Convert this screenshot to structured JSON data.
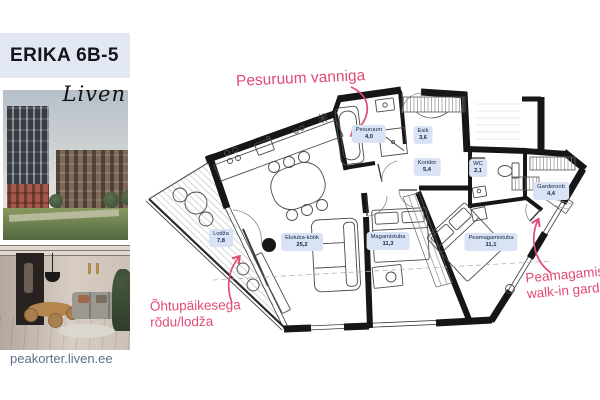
{
  "sidebar": {
    "title": "ERIKA 6B-5",
    "brand": "Liven",
    "footer_url": "peakorter.liven.ee",
    "photos": [
      {
        "name": "building-exterior-photo"
      },
      {
        "name": "interior-living-room-photo"
      }
    ]
  },
  "floor_plan": {
    "rooms": [
      {
        "name": "Lodža",
        "area": "7,8"
      },
      {
        "name": "Elutuba-köök",
        "area": "25,2"
      },
      {
        "name": "Pesuruum",
        "area": "4,0"
      },
      {
        "name": "Esik",
        "area": "3,6"
      },
      {
        "name": "Koridor",
        "area": "5,4"
      },
      {
        "name": "WC",
        "area": "2,1"
      },
      {
        "name": "Garderoob",
        "area": "4,4"
      },
      {
        "name": "Magamistuba",
        "area": "11,3"
      },
      {
        "name": "Peamagamistuba",
        "area": "11,1"
      }
    ],
    "annotations": {
      "washroom": {
        "line1": "Pesuruum vanniga"
      },
      "balcony": {
        "line1": "Õhtupäikesega",
        "line2": "rõdu/lodža"
      },
      "master": {
        "line1": "Peamagamistuba",
        "line2": "walk-in garderoobiga"
      }
    }
  },
  "colors": {
    "accent_pink": "#e14a74",
    "label_bg": "#d9e3f3",
    "label_text": "#16264d",
    "header_bg": "#e1e8f3",
    "wall_black": "#161616",
    "footer_text": "#5e7089"
  }
}
